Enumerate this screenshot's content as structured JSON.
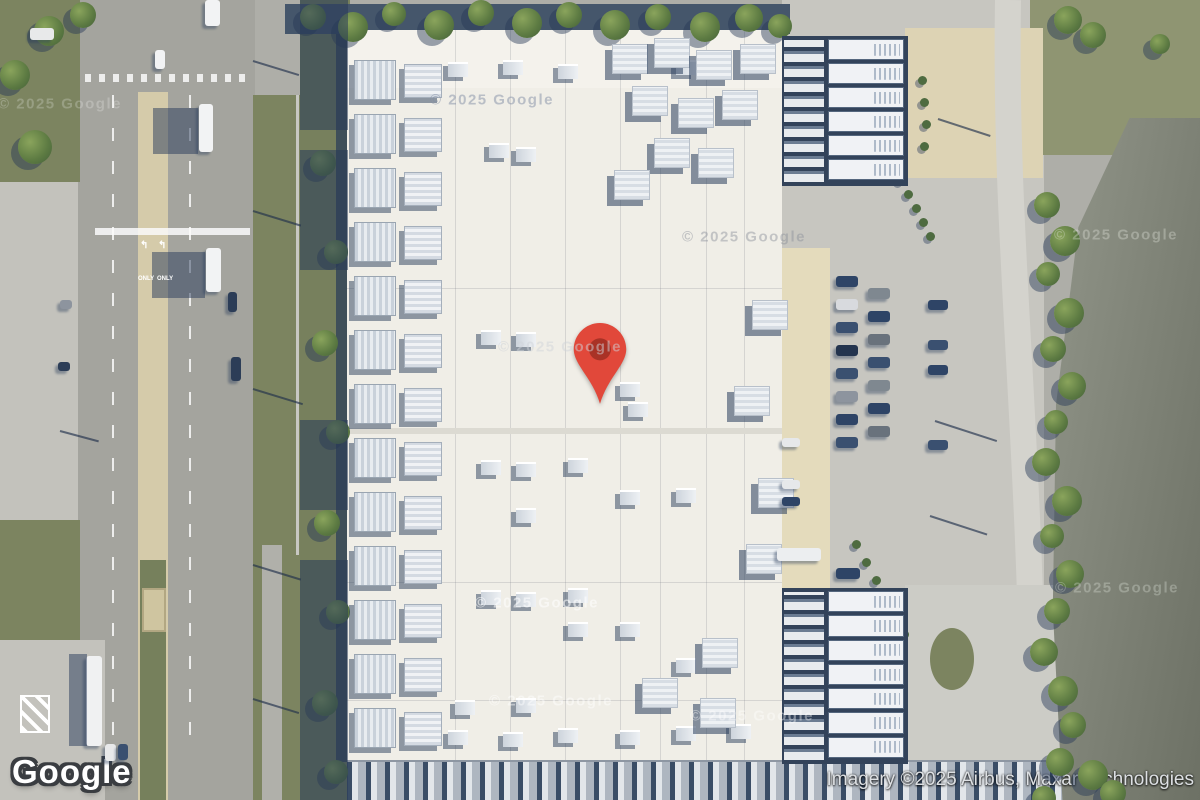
{
  "map": {
    "provider_logo": "Google",
    "attribution": "Imagery ©2025 Airbus, Maxar Technologies",
    "watermark": "© 2025 Google",
    "view_type": "satellite",
    "marker": {
      "x": 572,
      "y": 322,
      "color": "#E1483A",
      "dot_color": "#A93226"
    }
  },
  "road_markings": {
    "only_label": "ONLY",
    "turn_arrow": "↰"
  },
  "features": {
    "watermarks": [
      {
        "x": 60,
        "y": 104,
        "c": "rgba(255,255,255,0.22)"
      },
      {
        "x": 492,
        "y": 100,
        "c": "rgba(130,142,165,0.5)"
      },
      {
        "x": 744,
        "y": 237,
        "c": "rgba(138,143,152,0.45)"
      },
      {
        "x": 560,
        "y": 347,
        "c": "rgba(207,212,218,0.5)"
      },
      {
        "x": 537,
        "y": 603,
        "c": "rgba(255,255,255,0.55)"
      },
      {
        "x": 551,
        "y": 701,
        "c": "rgba(255,255,255,0.45)"
      },
      {
        "x": 752,
        "y": 716,
        "c": "rgba(255,255,255,0.4)"
      },
      {
        "x": 1117,
        "y": 588,
        "c": "rgba(225,230,220,0.32)"
      },
      {
        "x": 1116,
        "y": 235,
        "c": "rgba(225,230,220,0.35)"
      }
    ],
    "trees_top": [
      [
        300,
        4,
        26
      ],
      [
        338,
        12,
        30
      ],
      [
        382,
        2,
        24
      ],
      [
        424,
        10,
        30
      ],
      [
        468,
        0,
        26
      ],
      [
        512,
        8,
        30
      ],
      [
        556,
        2,
        26
      ],
      [
        600,
        10,
        30
      ],
      [
        645,
        4,
        26
      ],
      [
        690,
        12,
        30
      ],
      [
        735,
        4,
        28
      ],
      [
        768,
        14,
        24
      ],
      [
        18,
        130,
        34
      ],
      [
        0,
        60,
        30
      ],
      [
        34,
        16,
        30
      ],
      [
        70,
        2,
        26
      ],
      [
        1054,
        6,
        28
      ],
      [
        1080,
        22,
        26
      ],
      [
        1150,
        34,
        20
      ]
    ],
    "trees_strip": [
      [
        310,
        150,
        26
      ],
      [
        324,
        240,
        24
      ],
      [
        312,
        330,
        26
      ],
      [
        326,
        420,
        24
      ],
      [
        314,
        510,
        26
      ],
      [
        326,
        600,
        24
      ],
      [
        312,
        690,
        26
      ],
      [
        324,
        760,
        24
      ]
    ],
    "trees_right": [
      [
        1034,
        192,
        26
      ],
      [
        1050,
        226,
        30
      ],
      [
        1036,
        262,
        24
      ],
      [
        1054,
        298,
        30
      ],
      [
        1040,
        336,
        26
      ],
      [
        1058,
        372,
        28
      ],
      [
        1044,
        410,
        24
      ],
      [
        1032,
        448,
        28
      ],
      [
        1052,
        486,
        30
      ],
      [
        1040,
        524,
        24
      ],
      [
        1056,
        560,
        28
      ],
      [
        1044,
        598,
        26
      ],
      [
        1030,
        638,
        28
      ],
      [
        1048,
        676,
        30
      ],
      [
        1060,
        712,
        26
      ],
      [
        1046,
        748,
        28
      ],
      [
        1078,
        760,
        30
      ],
      [
        1100,
        780,
        26
      ],
      [
        1032,
        786,
        24
      ]
    ],
    "tree_dots": [
      [
        918,
        76
      ],
      [
        920,
        98
      ],
      [
        922,
        120
      ],
      [
        920,
        142
      ],
      [
        896,
        176
      ],
      [
        904,
        190
      ],
      [
        912,
        204
      ],
      [
        919,
        218
      ],
      [
        926,
        232
      ],
      [
        852,
        540
      ],
      [
        862,
        558
      ],
      [
        872,
        576
      ],
      [
        882,
        594
      ],
      [
        892,
        612
      ],
      [
        900,
        630
      ]
    ],
    "shadow_segments": [
      [
        0,
        130
      ],
      [
        150,
        120
      ],
      [
        420,
        90
      ],
      [
        560,
        140
      ],
      [
        700,
        100
      ]
    ],
    "vents": [
      [
        448,
        62
      ],
      [
        503,
        60
      ],
      [
        558,
        64
      ],
      [
        676,
        60
      ],
      [
        489,
        143
      ],
      [
        516,
        147
      ],
      [
        481,
        330
      ],
      [
        516,
        332
      ],
      [
        620,
        382
      ],
      [
        628,
        402
      ],
      [
        481,
        460
      ],
      [
        516,
        462
      ],
      [
        568,
        458
      ],
      [
        620,
        490
      ],
      [
        676,
        488
      ],
      [
        516,
        508
      ],
      [
        481,
        590
      ],
      [
        516,
        592
      ],
      [
        568,
        588
      ],
      [
        568,
        622
      ],
      [
        620,
        622
      ],
      [
        676,
        658
      ],
      [
        455,
        700
      ],
      [
        516,
        698
      ],
      [
        448,
        730
      ],
      [
        503,
        732
      ],
      [
        558,
        728
      ],
      [
        620,
        730
      ],
      [
        676,
        726
      ],
      [
        731,
        724
      ]
    ],
    "clusters": [
      [
        612,
        44
      ],
      [
        654,
        38
      ],
      [
        696,
        50
      ],
      [
        740,
        44
      ],
      [
        632,
        86
      ],
      [
        678,
        98
      ],
      [
        722,
        90
      ],
      [
        654,
        138
      ],
      [
        698,
        148
      ],
      [
        614,
        170
      ],
      [
        752,
        300
      ],
      [
        734,
        386
      ],
      [
        758,
        478
      ],
      [
        746,
        544
      ],
      [
        702,
        638
      ],
      [
        642,
        678
      ],
      [
        700,
        698
      ]
    ],
    "hvac_left": {
      "x": 350,
      "ys": [
        58,
        112,
        166,
        220,
        274,
        328,
        382,
        436,
        490,
        544,
        598,
        652,
        706
      ]
    },
    "cars": [
      [
        836,
        276,
        22,
        11,
        "#2e4466"
      ],
      [
        836,
        299,
        22,
        11,
        "#d8dade"
      ],
      [
        836,
        322,
        22,
        11,
        "#3a5070"
      ],
      [
        836,
        345,
        22,
        11,
        "#23344e"
      ],
      [
        836,
        368,
        22,
        11,
        "#3a5070"
      ],
      [
        836,
        391,
        22,
        11,
        "#8d949e"
      ],
      [
        836,
        414,
        22,
        11,
        "#2e4466"
      ],
      [
        836,
        437,
        22,
        11,
        "#3a5070"
      ],
      [
        868,
        288,
        22,
        11,
        "#7f8890"
      ],
      [
        868,
        311,
        22,
        11,
        "#2e4466"
      ],
      [
        868,
        334,
        22,
        11,
        "#69727c"
      ],
      [
        868,
        357,
        22,
        11,
        "#3a5070"
      ],
      [
        868,
        380,
        22,
        11,
        "#7f8890"
      ],
      [
        868,
        403,
        22,
        11,
        "#2e4466"
      ],
      [
        868,
        426,
        22,
        11,
        "#69727c"
      ],
      [
        928,
        300,
        20,
        10,
        "#2e4466"
      ],
      [
        928,
        340,
        20,
        10,
        "#3a5070"
      ],
      [
        928,
        365,
        20,
        10,
        "#2e4466"
      ],
      [
        928,
        440,
        20,
        10,
        "#3a5070"
      ],
      [
        782,
        438,
        18,
        9,
        "#e6e8ea"
      ],
      [
        782,
        480,
        18,
        9,
        "#e6e8ea"
      ],
      [
        782,
        497,
        18,
        9,
        "#2e4466"
      ],
      [
        777,
        548,
        44,
        13,
        "#eceef0"
      ],
      [
        836,
        568,
        24,
        11,
        "#2e4466"
      ],
      [
        199,
        104,
        14,
        48,
        "#f2f3f4"
      ],
      [
        206,
        248,
        15,
        44,
        "#f2f3f4"
      ],
      [
        228,
        292,
        9,
        20,
        "#2c3d57"
      ],
      [
        231,
        357,
        10,
        24,
        "#2c3d57"
      ],
      [
        155,
        50,
        10,
        19,
        "#f2f3f4"
      ],
      [
        205,
        0,
        15,
        26,
        "#f2f3f4"
      ],
      [
        30,
        28,
        24,
        12,
        "#e8e9ea"
      ],
      [
        86,
        656,
        16,
        90,
        "#f0f1f2"
      ],
      [
        105,
        744,
        11,
        17,
        "#e8e9ea"
      ],
      [
        118,
        744,
        10,
        16,
        "#3a5070"
      ],
      [
        60,
        300,
        12,
        9,
        "#8d949e"
      ],
      [
        58,
        362,
        12,
        9,
        "#2c3d57"
      ]
    ],
    "shadow_rects": [
      [
        153,
        108,
        45,
        46
      ],
      [
        152,
        252,
        53,
        46
      ],
      [
        69,
        654,
        18,
        92
      ]
    ],
    "pole_shadows": [
      [
        253,
        60,
        48,
        17
      ],
      [
        253,
        210,
        50,
        17
      ],
      [
        253,
        388,
        52,
        17
      ],
      [
        253,
        564,
        50,
        17
      ],
      [
        253,
        698,
        48,
        17
      ],
      [
        60,
        430,
        40,
        15
      ],
      [
        935,
        420,
        65,
        18
      ],
      [
        930,
        515,
        60,
        18
      ],
      [
        938,
        118,
        55,
        18
      ],
      [
        805,
        62,
        40,
        20
      ]
    ],
    "structures": [
      {
        "x": 782,
        "y": 36,
        "w": 126,
        "h": 150,
        "rows": 6
      },
      {
        "x": 782,
        "y": 588,
        "w": 126,
        "h": 176,
        "rows": 7
      }
    ],
    "only_positions": [
      [
        138,
        276
      ],
      [
        157,
        276
      ]
    ],
    "arrow_positions": [
      [
        140,
        240
      ],
      [
        158,
        240
      ]
    ]
  }
}
